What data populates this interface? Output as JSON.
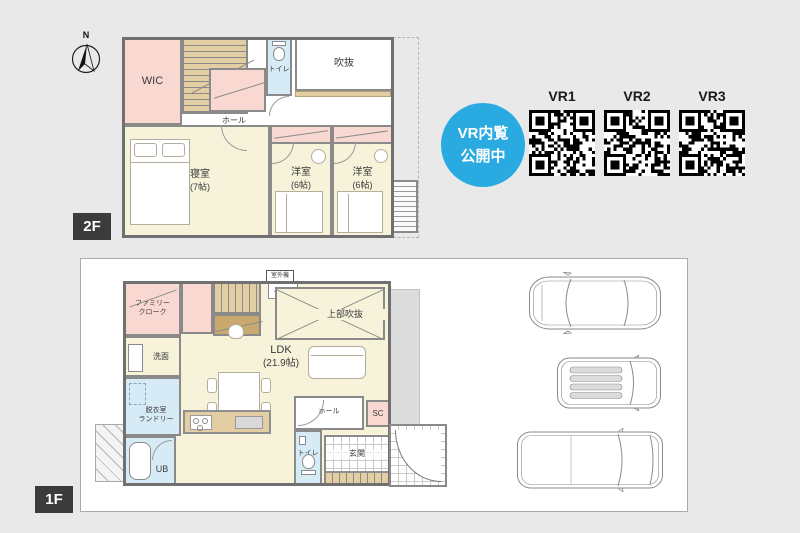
{
  "colors": {
    "background": "#e9e9e9",
    "room_cream": "#f6f3da",
    "room_pink": "#f8d8d1",
    "room_blue": "#d7ebf7",
    "stair_tan": "#e3cda3",
    "wall_gray": "#8a8a8a",
    "badge_blue": "#29abe2",
    "floor_tag_dark": "#3b3b3b"
  },
  "compass": {
    "north_label": "N"
  },
  "floor2": {
    "tag": "2F",
    "rooms": {
      "wic": "WIC",
      "toilet": "トイレ",
      "void": "吹抜",
      "hall": "ホール",
      "bedroom_name": "寝室",
      "bedroom_size": "(7帖)",
      "western1_name": "洋室",
      "western1_size": "(6帖)",
      "western2_name": "洋室",
      "western2_size": "(6帖)"
    }
  },
  "floor1": {
    "tag": "1F",
    "rooms": {
      "family_closet_line1": "ファミリー",
      "family_closet_line2": "クローク",
      "washroom": "洗面",
      "laundry_line1": "脱衣室",
      "laundry_line2": "ランドリー",
      "bath": "UB",
      "ldk_name": "LDK",
      "ldk_size": "(21.9帖)",
      "upper_void": "上部吹抜",
      "outdoor_unit": "室外機",
      "ac_unit": "A C",
      "hall": "ホール",
      "shoe_closet": "SC",
      "toilet": "トイレ",
      "entrance": "玄関"
    }
  },
  "vr": {
    "badge_line1": "VR内覧",
    "badge_line2": "公開中",
    "qr_codes": [
      {
        "label": "VR1"
      },
      {
        "label": "VR2"
      },
      {
        "label": "VR3"
      }
    ]
  }
}
